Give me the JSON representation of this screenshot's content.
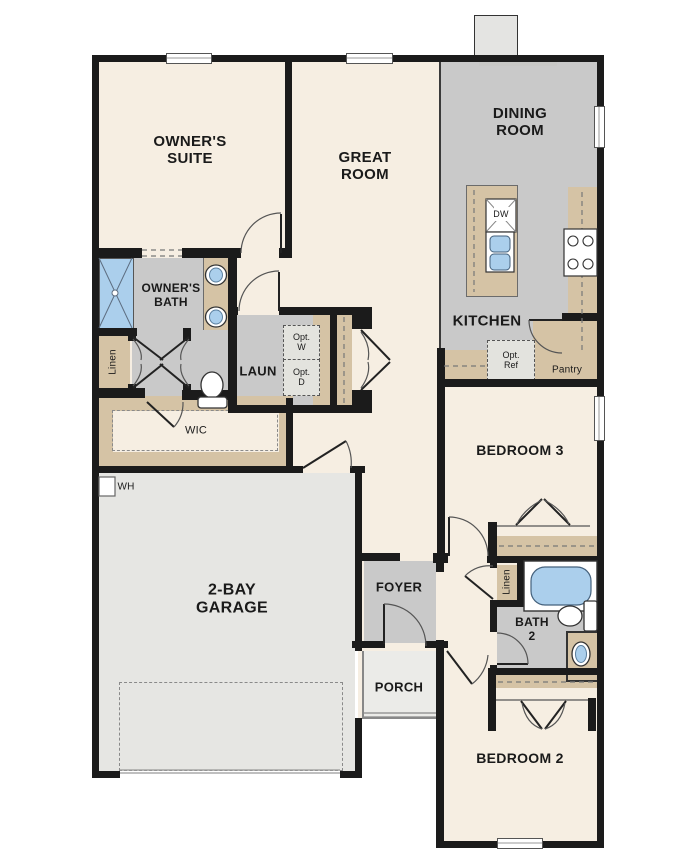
{
  "title": "Single-story floor plan",
  "colors": {
    "beige": "#f6eee2",
    "gray": "#c9c9c9",
    "garage": "#e6e6e3",
    "porch": "#ebebe8",
    "tan": "#d5c3a5",
    "blue": "#abcfec",
    "wall": "#1b1b1b"
  },
  "labels": {
    "owners_suite": "OWNER'S\nSUITE",
    "great_room": "GREAT\nROOM",
    "dining_room": "DINING\nROOM",
    "kitchen": "KITCHEN",
    "owners_bath": "OWNER'S\nBATH",
    "laundry": "LAUN",
    "wic": "WIC",
    "garage": "2-BAY\nGARAGE",
    "foyer": "FOYER",
    "porch": "PORCH",
    "bedroom3": "BEDROOM 3",
    "bath2": "BATH\n2",
    "bedroom2": "BEDROOM 2",
    "pantry": "Pantry",
    "linen_owners": "Linen",
    "linen_hall": "Linen",
    "opt_w": "Opt.\nW",
    "opt_d": "Opt.\nD",
    "opt_ref": "Opt.\nRef",
    "dw": "DW",
    "wh": "WH"
  }
}
